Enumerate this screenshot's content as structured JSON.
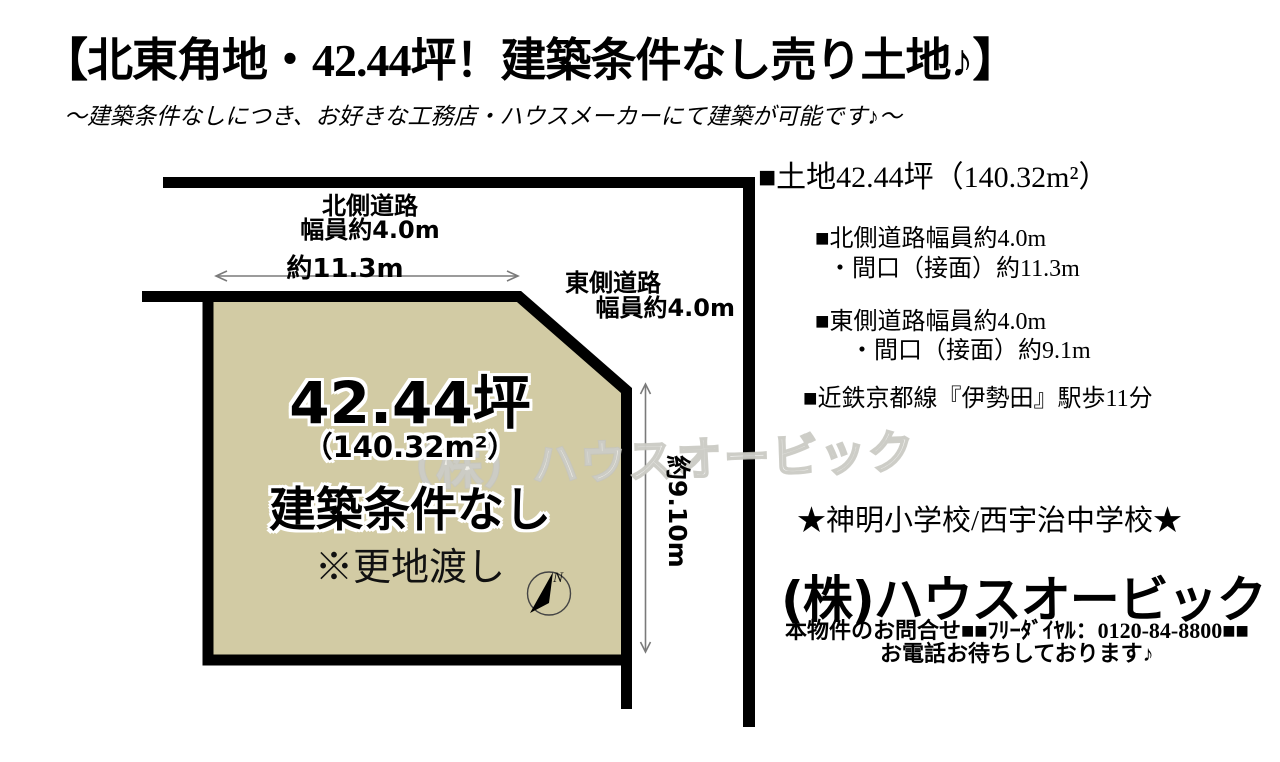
{
  "header": {
    "title": "【北東角地・42.44坪！建築条件なし売り土地♪】",
    "subtitle": "～建築条件なしにつき、お好きな工務店・ハウスメーカーにて建築が可能です♪～"
  },
  "diagram": {
    "north_road": {
      "line1": "北側道路",
      "line2": "幅員約4.0m"
    },
    "north_frontage": "約11.3m",
    "east_road": {
      "line1": "東側道路",
      "line2": "幅員約4.0m"
    },
    "east_depth": "約9.10m",
    "plot": {
      "area_tsubo": "42.44坪",
      "area_m2": "（140.32m²）",
      "condition": "建築条件なし",
      "handover_note": "※更地渡し"
    },
    "compass": {
      "label": "N"
    },
    "colors": {
      "plot_fill": "#d2cba4",
      "road_line": "#000000",
      "dimension_line": "#7a7a7a"
    }
  },
  "watermark": {
    "text": "（株）ハウスオービック"
  },
  "details": {
    "land_area": "■土地42.44坪（140.32m²）",
    "items": [
      "■北側道路幅員約4.0m",
      "・間口（接面）約11.3m",
      "■東側道路幅員約4.0m",
      "・間口（接面）約9.1m",
      "■近鉄京都線『伊勢田』駅歩11分"
    ],
    "schools": "★神明小学校/西宇治中学校★",
    "company": "(株)ハウスオービック",
    "contact_line1": "本物件のお問合せ■■ﾌﾘｰﾀﾞｲﾔﾙ：0120-84-8800■■",
    "contact_line2": "お電話お待ちしております♪"
  }
}
